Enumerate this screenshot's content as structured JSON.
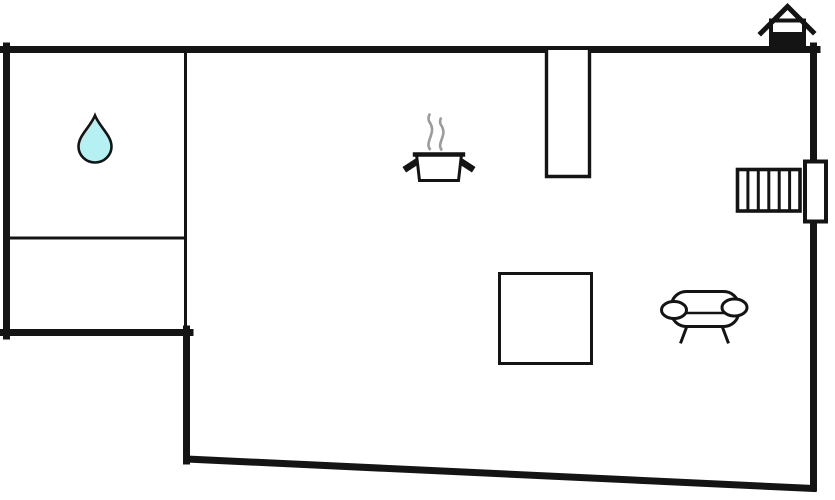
{
  "page": {
    "title": "Property floor plan",
    "type": "floor-plan-diagram"
  },
  "colors": {
    "wall": "#141414",
    "floor": "#ffffff",
    "water_drop": "#b5f1f3",
    "steam": "#9c9c9c"
  },
  "icons": {
    "water_drop": "water drop (bathroom)",
    "cooking_pot": "cooking pot with steam (kitchen)",
    "stairs": "staircase",
    "door": "door opening",
    "table": "square table",
    "sofa": "sofa (living area)",
    "house": "house entrance marker",
    "wall_stub": "interior wall stub"
  }
}
